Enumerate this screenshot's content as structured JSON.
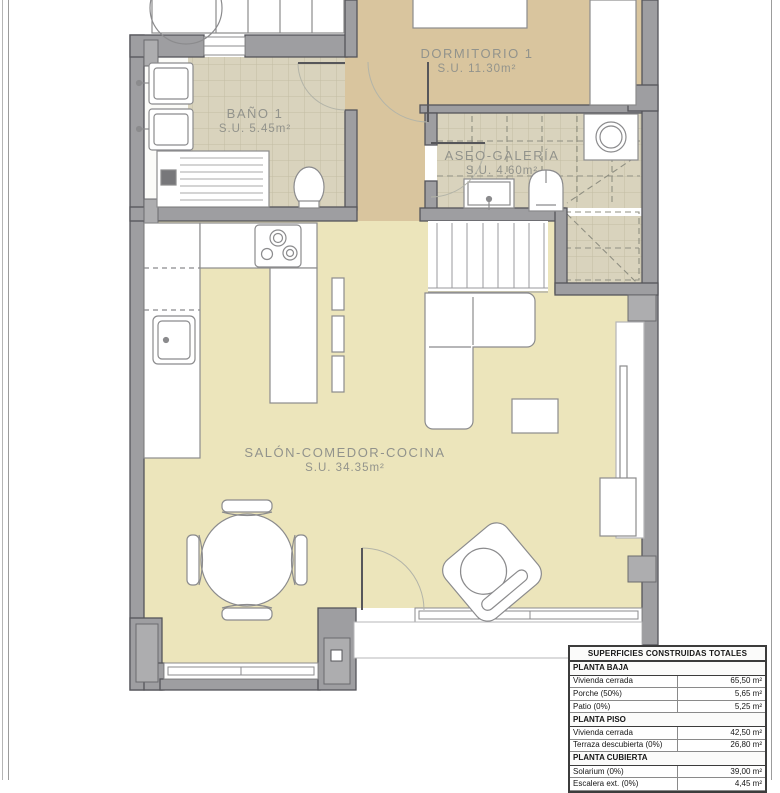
{
  "rooms": {
    "dormitorio": {
      "name": "DORMITORIO 1",
      "area": "S.U. 11.30m²"
    },
    "bano": {
      "name": "BAÑO 1",
      "area": "S.U. 5.45m²"
    },
    "aseo": {
      "name": "ASEO-GALERÍA",
      "area": "S.U. 4.60m²"
    },
    "salon": {
      "name": "SALÓN-COMEDOR-COCINA",
      "area": "S.U. 34.35m²"
    }
  },
  "surfaces_table": {
    "title": "SUPERFICIES CONSTRUIDAS TOTALES",
    "sections": [
      {
        "header": "PLANTA BAJA",
        "rows": [
          {
            "label": "Vivienda cerrada",
            "value": "65,50 m²"
          },
          {
            "label": "Porche (50%)",
            "value": "5,65 m²"
          },
          {
            "label": "Patio (0%)",
            "value": "5,25 m²"
          }
        ]
      },
      {
        "header": "PLANTA PISO",
        "rows": [
          {
            "label": "Vivienda cerrada",
            "value": "42,50 m²"
          },
          {
            "label": "Terraza descubierta (0%)",
            "value": "26,80 m²"
          }
        ]
      },
      {
        "header": "PLANTA CUBIERTA",
        "rows": [
          {
            "label": "Solarium (0%)",
            "value": "39,00 m²"
          },
          {
            "label": "Escalera ext. (0%)",
            "value": "4,45 m²"
          }
        ]
      }
    ]
  },
  "colors": {
    "wall": "#9e9ea1",
    "bedroom_floor": "#d9c59e",
    "tile_floor": "#d9d3bd",
    "living_floor": "#ece5bb",
    "label_text": "#92938c",
    "table_border": "#3c3c3c"
  }
}
